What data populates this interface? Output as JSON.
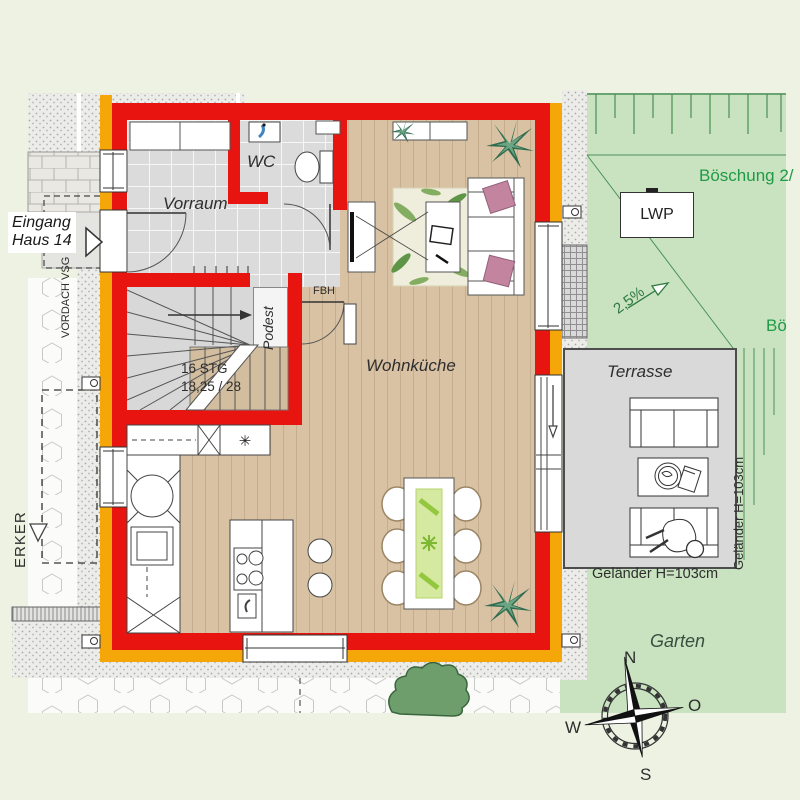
{
  "title": "Grundriss Erdgeschoss Haus 14",
  "labels": {
    "eingang_line1": "Eingang",
    "eingang_line2": "Haus 14",
    "vordach": "VORDACH VSG",
    "erker": "ERKER",
    "vorraum": "Vorraum",
    "wc": "WC",
    "podest": "Podest",
    "fbh": "FBH",
    "stairs_count": "16 STG",
    "stairs_dim": "18,25 / 28",
    "wohnkueche": "Wohnküche",
    "boeschung_top": "Böschung 2/",
    "boeschung_right": "Bö",
    "lwp": "LWP",
    "slope": "2,5%",
    "terrasse": "Terrasse",
    "gelaender_right": "Geländer H=103cm",
    "gelaender_bottom": "Geländer H=103cm",
    "garten": "Garten",
    "freezer_symbol": "✳"
  },
  "compass": {
    "n": "N",
    "o": "O",
    "s": "S",
    "w": "W"
  },
  "colors": {
    "wall_red": "#e81410",
    "insulation_orange": "#f5a608",
    "garden_green": "#c9e3c1",
    "terrace_grey": "#d9d9d9",
    "wood_floor": "#d8c2a3",
    "tile_grey": "#dbdbdb",
    "green_text": "#1f9b45",
    "background": "#edf2e3",
    "pillow_pink": "#c2849e"
  }
}
